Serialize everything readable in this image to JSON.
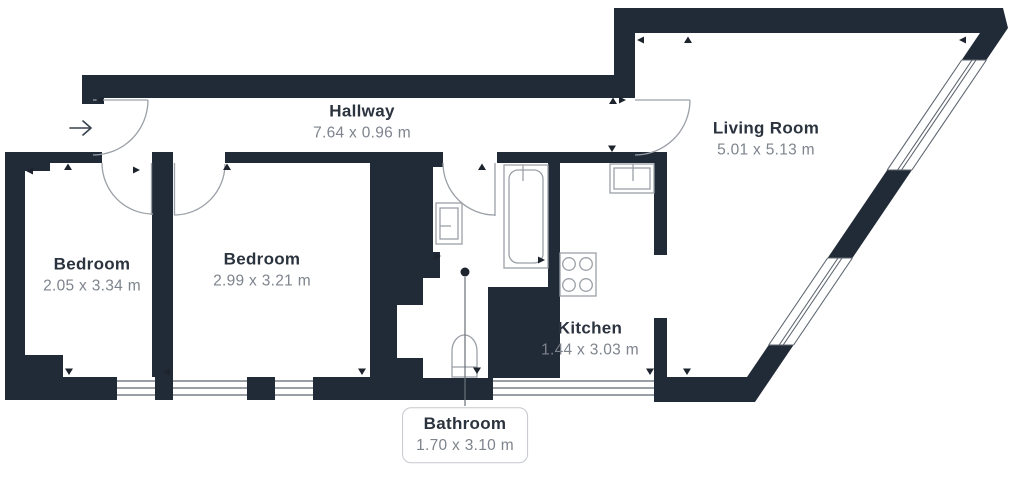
{
  "plan": {
    "type": "floor-plan",
    "background_color": "#ffffff",
    "wall_color": "#212a37",
    "line_color": "#9ba0a7",
    "window_line_color": "#5d656f",
    "room_name_color": "#2b333e",
    "dimension_text_color": "#7e848d",
    "entry_arrow_symbol": "→"
  },
  "rooms": [
    {
      "key": "hallway",
      "name": "Hallway",
      "dims": "7.64 x 0.96 m"
    },
    {
      "key": "living-room",
      "name": "Living Room",
      "dims": "5.01 x 5.13 m"
    },
    {
      "key": "bedroom-1",
      "name": "Bedroom",
      "dims": "2.05 x 3.34 m"
    },
    {
      "key": "bedroom-2",
      "name": "Bedroom",
      "dims": "2.99 x 3.21 m"
    },
    {
      "key": "kitchen",
      "name": "Kitchen",
      "dims": "1.44 x 3.03 m"
    },
    {
      "key": "bathroom",
      "name": "Bathroom",
      "dims": "1.70 x 3.10 m"
    }
  ],
  "fixtures": [
    "bathtub-icon",
    "bathroom-sink-icon",
    "toilet-icon",
    "kitchen-sink-icon",
    "stove-icon"
  ],
  "doors": [
    "entry-door",
    "bedroom-1-door",
    "bedroom-2-door",
    "bathroom-door",
    "living-room-door"
  ],
  "windows_count": 6
}
